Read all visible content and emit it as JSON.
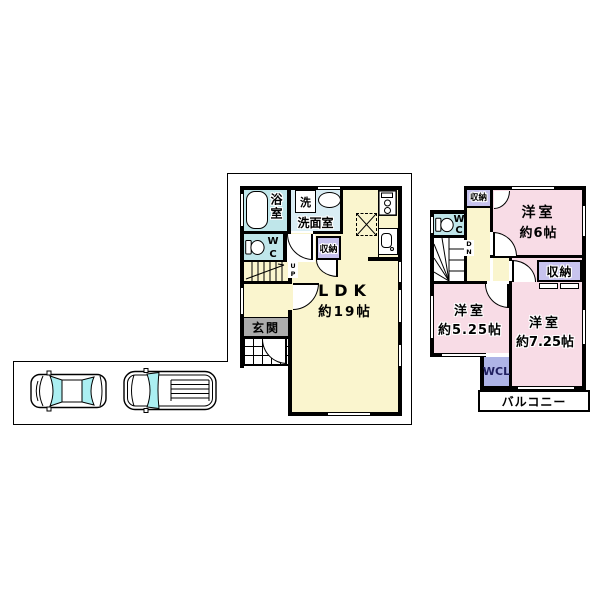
{
  "floorplan": {
    "first_floor": {
      "bathroom": "浴室",
      "washer": "洗",
      "washroom": "洗面室",
      "wc": [
        "W",
        "C"
      ],
      "storage": "収納",
      "stairs_up": [
        "U",
        "P"
      ],
      "entrance": "玄関",
      "ldk": "LDK",
      "ldk_size": "約19帖"
    },
    "second_floor": {
      "storage_top": "収納",
      "wc": [
        "W",
        "C"
      ],
      "stairs_down": [
        "D",
        "N"
      ],
      "bedroom_6": "洋室",
      "bedroom_6_size": "約6帖",
      "storage_mid": "収納",
      "bedroom_5_25": "洋室",
      "bedroom_5_25_size": "約5.25帖",
      "bedroom_7_25": "洋室",
      "bedroom_7_25_size": "約7.25帖",
      "wcl": "WCL",
      "balcony": "バルコニー"
    },
    "colors": {
      "room_yellow": "#FAF5CE",
      "room_pink": "#F8DCE6",
      "wet_area_teal": "#BFE6EA",
      "washroom_blue": "#D9EDF4",
      "storage_lavender": "#C7C3EE",
      "wcl_blue": "#AEB4E6",
      "entrance_gray": "#ACACAC",
      "car_glass_cyan": "#ABEFF2",
      "line_black": "#000000"
    },
    "parking": {
      "vehicle_1": "sedan",
      "vehicle_2": "wagon"
    }
  }
}
